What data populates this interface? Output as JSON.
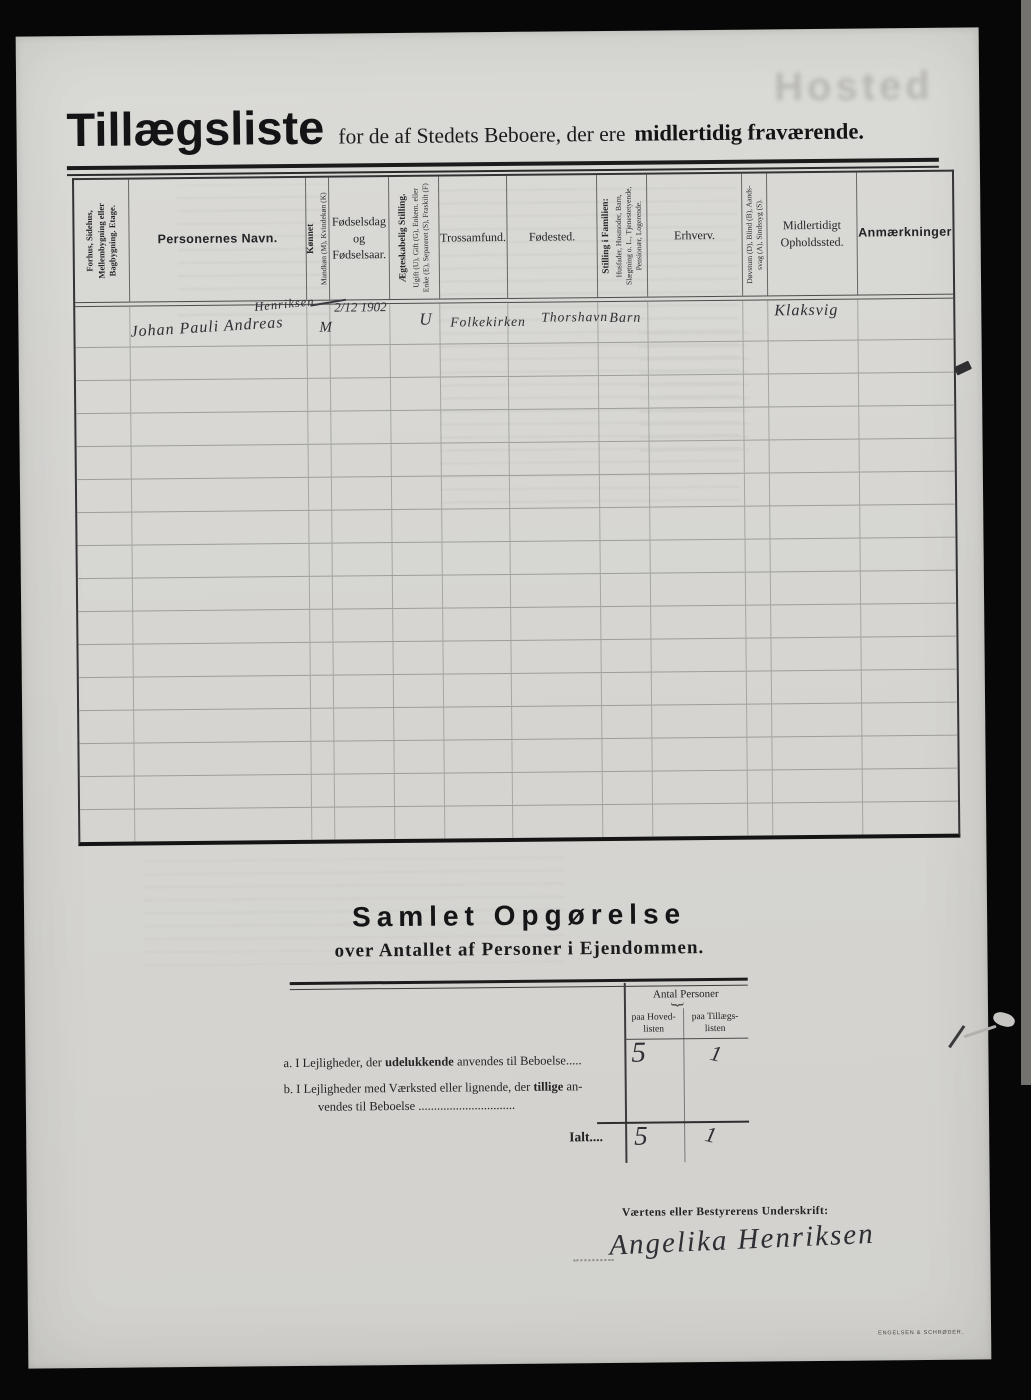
{
  "page": {
    "watermark": "Hosted",
    "printer_mark": "ENGELSEN & SCHRØDER."
  },
  "header": {
    "title": "Tillægsliste",
    "subtitle": "for de af Stedets Beboere, der ere",
    "subtitle_emphasis": "midlertidig fraværende."
  },
  "table": {
    "columns": [
      {
        "id": "bygning",
        "rotated": true,
        "main": "",
        "sub": "Forhus, Sidehus, Mellembygning eller Bagbygning.  Etage.",
        "strong": true,
        "width": 55
      },
      {
        "id": "navn",
        "rotated": false,
        "main": "Personernes Navn.",
        "emph": true,
        "width": 177
      },
      {
        "id": "koennet",
        "rotated": true,
        "main": "Kønnet",
        "sub": "Mandkøn (M), Kvindekøn (K)",
        "width": 23
      },
      {
        "id": "foedselsdag",
        "rotated": false,
        "main": "Fødselsdag\nog\nFødselsaar.",
        "width": 60
      },
      {
        "id": "aegteskabelig",
        "rotated": true,
        "main": "Ægteskabelig Stilling.",
        "sub": "Ugift (U), Gift (G), Enkem. eller Enke (E), Separeret (S), Fraskilt (F)",
        "width": 50
      },
      {
        "id": "trossamfund",
        "rotated": false,
        "main": "Trossamfund.",
        "width": 68
      },
      {
        "id": "foedested",
        "rotated": false,
        "main": "Fødested.",
        "width": 90
      },
      {
        "id": "stilling",
        "rotated": true,
        "main": "Stilling i Familien:",
        "sub": "Husfader, Husmoder, Barn, Slægtning o. L., Tjenestetyende, Pensionær, Logerende.",
        "width": 50
      },
      {
        "id": "erhverv",
        "rotated": false,
        "main": "Erhverv.",
        "width": 95
      },
      {
        "id": "doevstum",
        "rotated": true,
        "main": "",
        "sub": "Døvstum (D), Blind (B), Aands- svag (A), Sindssyg (S).",
        "width": 25
      },
      {
        "id": "opholdssted",
        "rotated": false,
        "main": "Midlertidigt\nOpholdssted.",
        "width": 90
      },
      {
        "id": "anmaerkninger",
        "rotated": false,
        "main": "Anmærkninger",
        "emph": true,
        "width": 95
      }
    ],
    "empty_row_count": 15,
    "entry": {
      "name": "Johan Pauli Andreas",
      "name_insertion": "Henriksen",
      "sex": "M",
      "birth": "2/12 1902",
      "marital": "U",
      "faith": "Folkekirken",
      "birthplace": "Thorshavn",
      "family_position": "Barn",
      "temporary_residence": "Klaksvig"
    }
  },
  "summary": {
    "heading": "Samlet Opgørelse",
    "subheading": "over Antallet af Personer i Ejendommen.",
    "col_group": "Antal Personer",
    "col_hoved": "paa Hoved-\nlisten",
    "col_tillaeg": "paa Tillægs-\nlisten",
    "row_a_prefix": "a.",
    "row_a_1": "I Lejligheder, der",
    "row_a_bold": "udelukkende",
    "row_a_2": "anvendes til Beboelse.....",
    "row_b_prefix": "b.",
    "row_b_1": "I Lejligheder med Værksted eller lignende, der",
    "row_b_bold": "tillige",
    "row_b_2": "an-",
    "row_b_line2": "vendes til Beboelse ...............................",
    "total_label": "Ialt....",
    "values": {
      "a_hoved": "5",
      "a_tillaeg": "1",
      "total_hoved": "5",
      "total_tillaeg": "1"
    }
  },
  "signature": {
    "label": "Værtens eller Bestyrerens Underskrift:",
    "name": "Angelika Henriksen"
  }
}
